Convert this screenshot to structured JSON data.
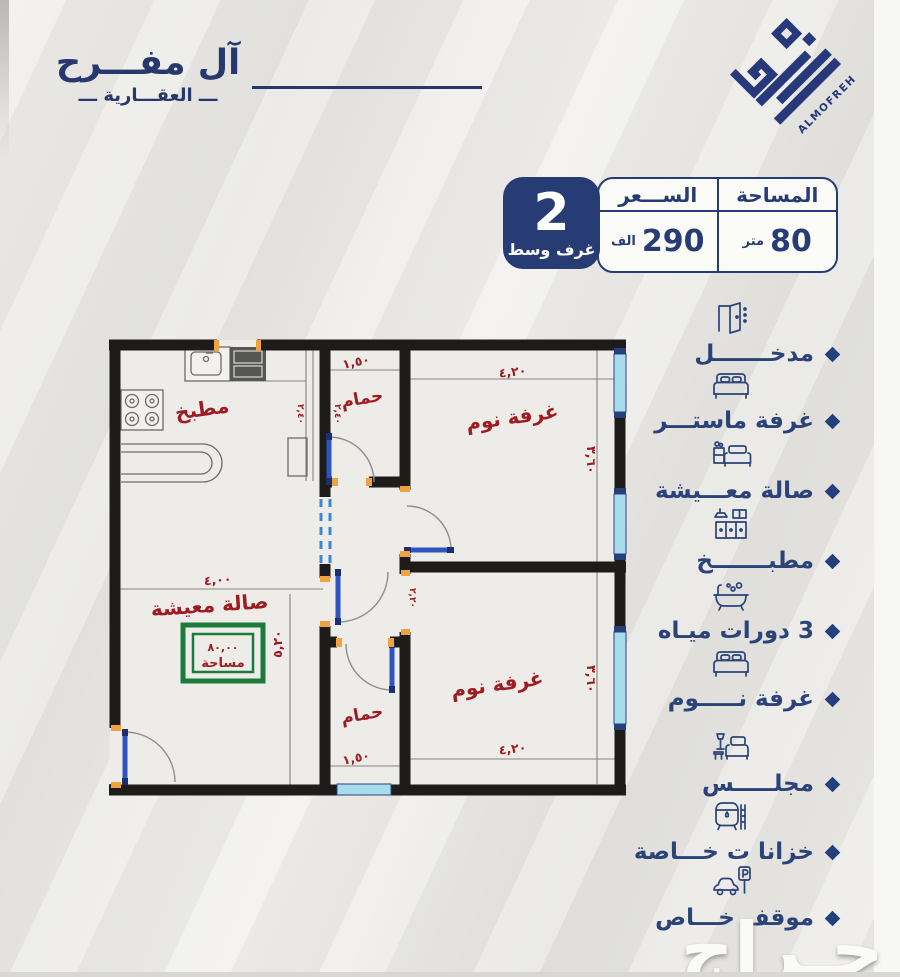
{
  "brand": {
    "name_ar_1": "آل مفـــرح",
    "name_ar_2": "ـــ العقـــارية ـــ",
    "name_en": "ALMOFREH"
  },
  "summary": {
    "rooms_count": "2",
    "rooms_label": "غرف وسط",
    "price_label": "الســـعر",
    "price_value": "290",
    "price_unit": "الف",
    "area_label": "المساحة",
    "area_value": "80",
    "area_unit": "متر"
  },
  "floorplan": {
    "room_kitchen": "مطبخ",
    "room_bath_top": "حمام",
    "room_bedroom_top": "غرفة نوم",
    "room_living": "صالة معيشة",
    "room_bath_bottom": "حمام",
    "room_bedroom_bottom": "غرفة نوم",
    "dim_bath_top": "١,٥٠",
    "dim_bedroom_top_w": "٤,٢٠",
    "dim_bedroom_top_h": "٣,٦٠",
    "dim_living_w": "٤,٠٠",
    "dim_living_h": "٥,٢٠",
    "dim_bath_bottom": "١,٥٠",
    "dim_bedroom_bottom_w": "٤,٢٠",
    "dim_bedroom_bottom_h": "٣,٦٠",
    "dim_small_a": "٢,٤٠",
    "dim_small_b": "٢,٤٠",
    "dim_small_c": "٢,٢٠",
    "area_box_value": "٨٠,٠٠",
    "area_box_label": "مساحة"
  },
  "features": [
    {
      "icon": "door-icon",
      "label": "مدخـــــــل"
    },
    {
      "icon": "bed-icon",
      "label": "غرفة ماستـــر"
    },
    {
      "icon": "living-room-icon",
      "label": "صالة معـــيشة"
    },
    {
      "icon": "kitchen-icon",
      "label": "مطبـــــــخ"
    },
    {
      "icon": "bathtub-icon",
      "label": "3 دورات ميـاه"
    },
    {
      "icon": "bed-icon",
      "label": "غرفة نـــــوم"
    },
    {
      "icon": "majlis-icon",
      "label": "مجلـــــس"
    },
    {
      "icon": "water-tank-icon",
      "label": "خزانا ت خـــاصة"
    },
    {
      "icon": "parking-icon",
      "label": "موقف خـــاص"
    }
  ],
  "watermark": "حـراج",
  "colors": {
    "navy": "#27397a",
    "plan_red": "#9e1b21",
    "green": "#1b7b3b",
    "wall": "#1d1c1a",
    "window_cyan": "#a8dcec",
    "door_blue": "#2e55bd",
    "jamb_orange": "#f0a23e"
  }
}
